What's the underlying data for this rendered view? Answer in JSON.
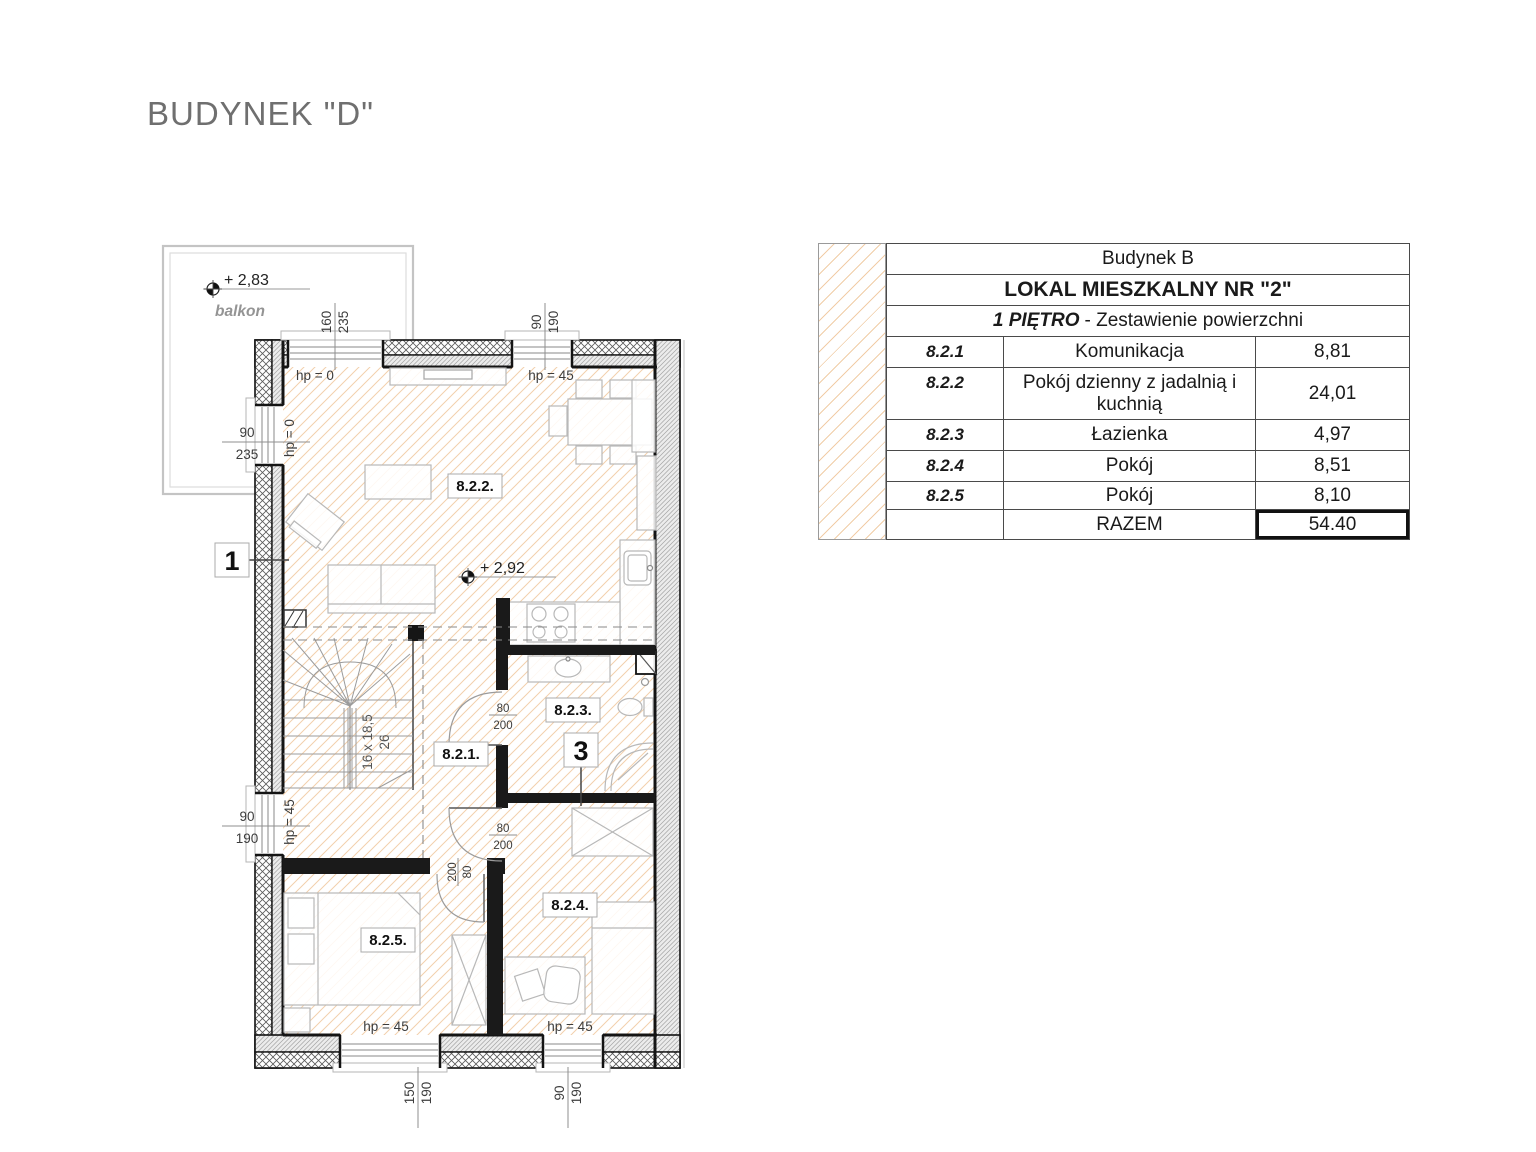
{
  "title": "BUDYNEK \"D\"",
  "table": {
    "header1": "Budynek B",
    "header2": "LOKAL MIESZKALNY NR \"2\"",
    "header3_bold": "1 PIĘTRO",
    "header3_rest": "- Zestawienie powierzchni",
    "rows": [
      {
        "id": "8.2.1",
        "name": "Komunikacja",
        "area": "8,81"
      },
      {
        "id": "8.2.2",
        "name": "Pokój dzienny z jadalnią i kuchnią",
        "area": "24,01"
      },
      {
        "id": "8.2.3",
        "name": "Łazienka",
        "area": "4,97"
      },
      {
        "id": "8.2.4",
        "name": "Pokój",
        "area": "8,51"
      },
      {
        "id": "8.2.5",
        "name": "Pokój",
        "area": "8,10"
      }
    ],
    "total_label": "RAZEM",
    "total_value": "54.40"
  },
  "plan": {
    "balcony": {
      "level": "+ 2,83",
      "label": "balkon"
    },
    "level2": "+ 2,92",
    "markers": {
      "m1": "1",
      "m3": "3"
    },
    "rooms": {
      "r821": "8.2.1.",
      "r822": "8.2.2.",
      "r823": "8.2.3.",
      "r824": "8.2.4.",
      "r825": "8.2.5."
    },
    "stairs": {
      "line1": "16 x 18,5",
      "line2": "26"
    },
    "hp": {
      "zero": "hp = 0",
      "f45": "hp = 45"
    },
    "dims": {
      "top1": {
        "w": "160",
        "h": "235"
      },
      "top2": {
        "w": "90",
        "h": "190"
      },
      "left1": {
        "w": "90",
        "h": "235"
      },
      "left2": {
        "w": "90",
        "h": "190"
      },
      "bottom1": {
        "w": "150",
        "h": "190"
      },
      "bottom2": {
        "w": "90",
        "h": "190"
      },
      "door": {
        "w": "80",
        "h": "200"
      },
      "door_rot": {
        "w": "200",
        "h": "80"
      }
    }
  },
  "colors": {
    "floor_hatch": "#f2d0ac",
    "table_hatch": "#f1cda7",
    "wall_black": "#161616",
    "wall_gray_fill": "#ececec",
    "title_gray": "#6f6f6f",
    "furniture_gray": "#b8b8b8"
  }
}
